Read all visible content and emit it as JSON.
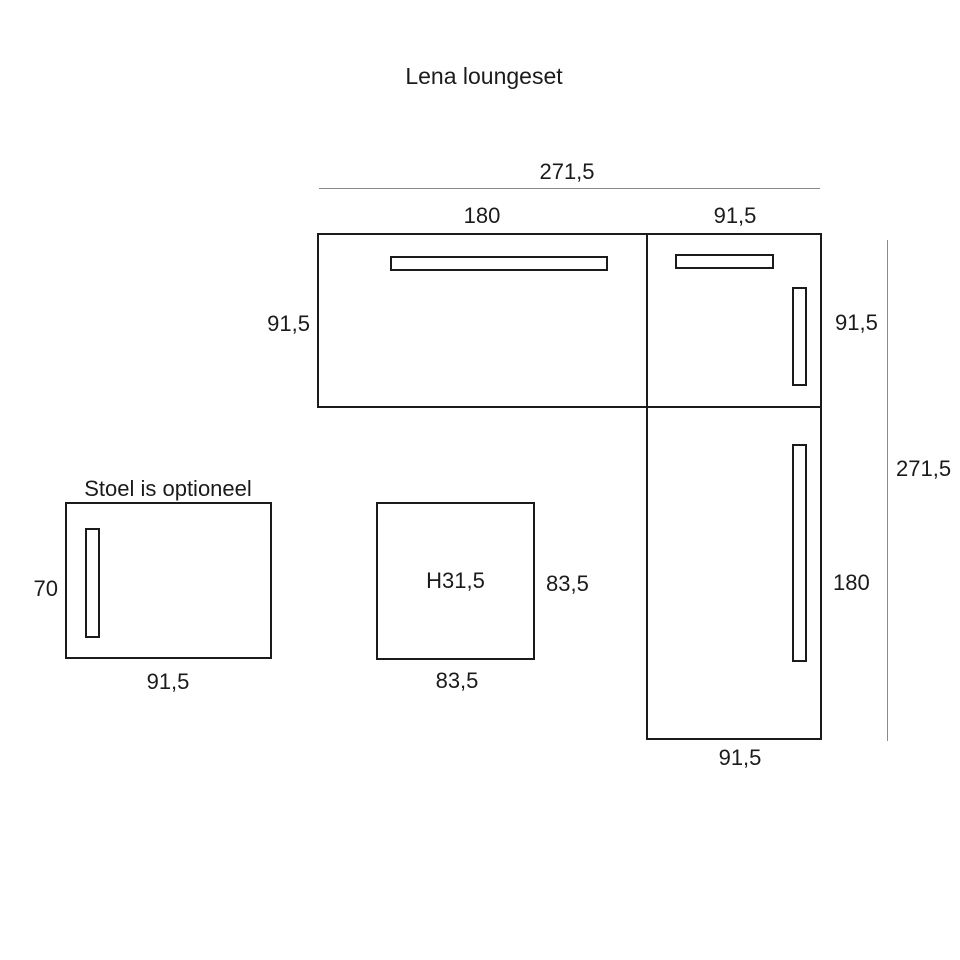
{
  "title": "Lena loungeset",
  "colors": {
    "outline": "#1b1b1b",
    "dimension_line": "#8a8a8a",
    "text": "#1b1b1b",
    "background": "#ffffff"
  },
  "sofa": {
    "overall_width": "271,5",
    "overall_depth": "271,5",
    "long_section": {
      "width": "180",
      "depth": "91,5"
    },
    "corner_section": {
      "width": "91,5",
      "depth": "91,5"
    },
    "short_section": {
      "width": "91,5",
      "length": "180"
    }
  },
  "chair": {
    "note": "Stoel is optioneel",
    "depth": "70",
    "width": "91,5"
  },
  "table": {
    "height": "H31,5",
    "depth": "83,5",
    "width": "83,5"
  }
}
